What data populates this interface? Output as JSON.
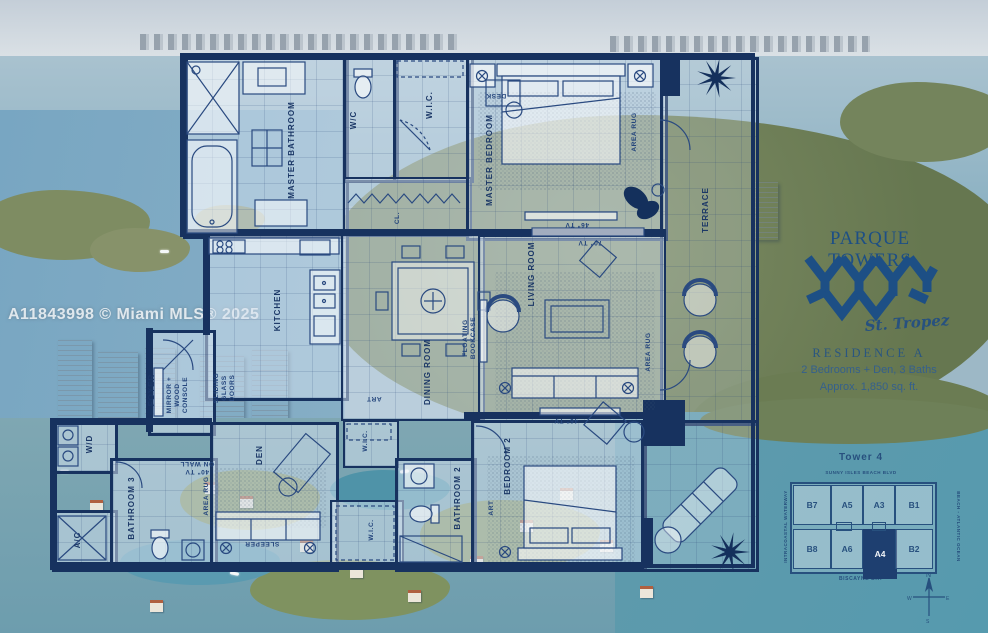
{
  "watermark": "A11843998 © Miami MLS® 2025",
  "branding": {
    "name": "PARQUE TOWERS",
    "script": "St. Tropez",
    "residence": "RESIDENCE A",
    "info_line1": "2 Bedrooms + Den, 3 Baths",
    "info_line2": "Approx. 1,850 sq. ft.",
    "brand_navy": "#1d4f85"
  },
  "floorplan": {
    "colors": {
      "wall_navy": "#17325f"
    },
    "rooms": {
      "master_bathroom": "MASTER BATHROOM",
      "wc": "W/C",
      "wic_master": "W.I.C.",
      "closet": "CL.",
      "master_bedroom": "MASTER BEDROOM",
      "terrace": "TERRACE",
      "kitchen": "KITCHEN",
      "dining_room": "DINING ROOM",
      "living_room": "LIVING ROOM",
      "foyer": "FOYER",
      "den": "DEN",
      "wd": "W/D",
      "ac": "A/C",
      "bathroom_3": "BATHROOM 3",
      "wic_den": "W.I.C.",
      "wic_bedroom2": "W.I.C.",
      "bathroom_2": "BATHROOM 2",
      "bedroom_2": "BEDROOM 2"
    },
    "annotations": {
      "desk": "DESK",
      "area_rug": "AREA RUG",
      "tv_46": "46\" TV",
      "tv_70": "70\" TV",
      "tv_40_wall": "40\" TV\nON WALL",
      "sliding_doors": "SLIDING\nGLASS\nDOORS",
      "mirror_console": "MIRROR +\nWOOD\nCONSOLE",
      "floating_bookcase": "FLOATING\nBOOKCASE",
      "art": "ART",
      "sleeper": "SLEEPER"
    }
  },
  "keyplan": {
    "title": "Tower 4",
    "street": "SUNNY ISLES BEACH BLVD",
    "left_label": "INTRACOASTAL WATERWAY",
    "right_label": "BEACH - ATLANTIC OCEAN",
    "bottom_label": "BISCAYNE BAY",
    "highlight_unit": "A4",
    "highlight_color": "#1e3f70",
    "units": [
      "B7",
      "A5",
      "A3",
      "B1",
      "B8",
      "A6",
      "A4",
      "B2"
    ],
    "compass": {
      "n": "N",
      "e": "E",
      "s": "S",
      "w": "W"
    }
  }
}
